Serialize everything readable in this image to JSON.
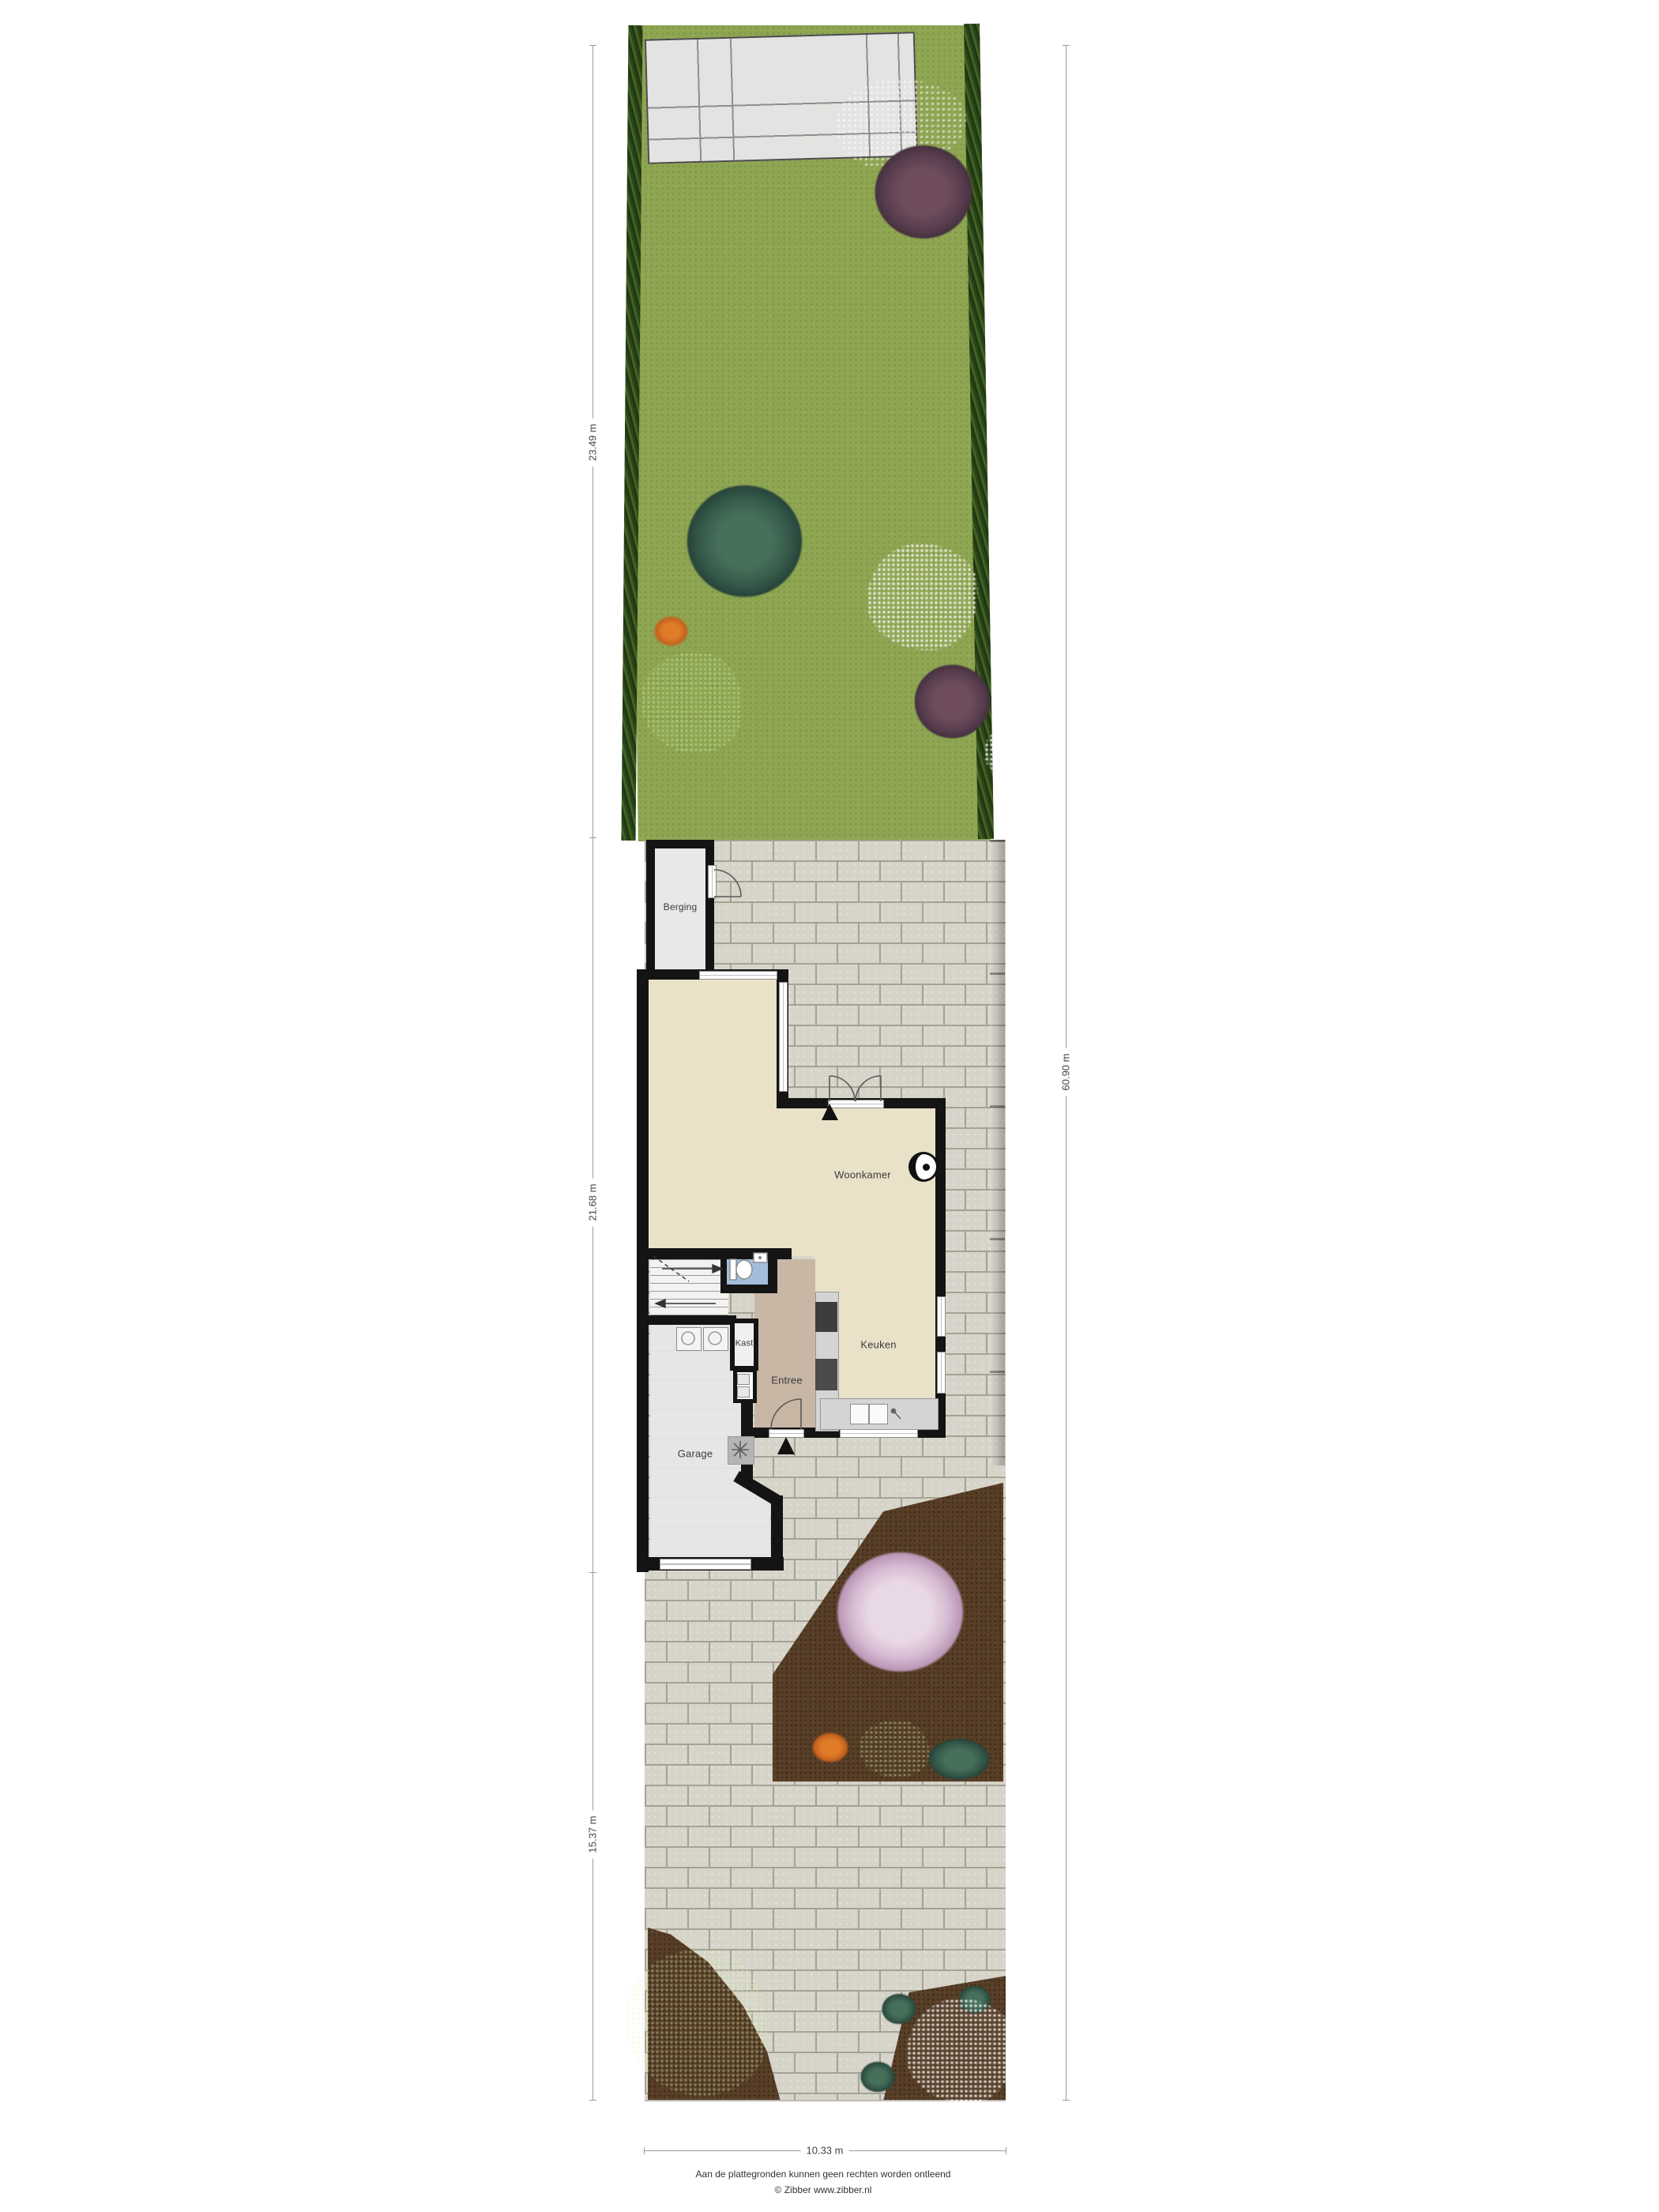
{
  "rooms": {
    "berging": "Berging",
    "woonkamer": "Woonkamer",
    "keuken": "Keuken",
    "entree": "Entree",
    "kast": "Kast",
    "garage": "Garage"
  },
  "dimensions": {
    "garden_depth": "23.49 m",
    "house_depth": "21.68 m",
    "driveway_depth": "15.37 m",
    "total_depth": "60.90 m",
    "plot_width": "10.33 m"
  },
  "footer": {
    "disclaimer": "Aan de plattegronden kunnen geen rechten worden ontleend",
    "credit": "© Zibber www.zibber.nl"
  },
  "colors": {
    "lawn": "#8ea551",
    "hedge": "#35511e",
    "brick": "#d6d3c8",
    "mortar": "#a5a295",
    "fence": "#8a4a16",
    "soil": "#573e27",
    "wall": "#141414",
    "floor_living": "#e9e1c8",
    "floor_entry": "#c8b7a5",
    "floor_wc": "#a3bedd",
    "floor_garage": "#e6e6e6"
  }
}
